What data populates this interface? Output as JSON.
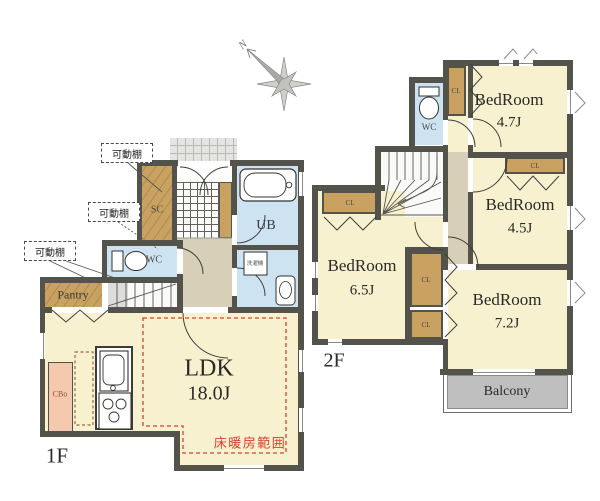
{
  "floor1": {
    "label": "1F",
    "rooms": {
      "ldk": {
        "name": "LDK",
        "area": "18.0J"
      },
      "pantry": {
        "name": "Pantry"
      },
      "toilet": {
        "name": "WC"
      },
      "shoe_closet": {
        "name": "SC"
      },
      "bath": {
        "name": "UB"
      },
      "cupboard": {
        "name": "CBo"
      }
    },
    "notes": {
      "movable_shelf": "可動棚",
      "floor_heating_area": "床暖房範囲",
      "washer": "洗濯機"
    }
  },
  "floor2": {
    "label": "2F",
    "rooms": {
      "bedroom_47": {
        "name": "BedRoom",
        "area": "4.7J"
      },
      "bedroom_45": {
        "name": "BedRoom",
        "area": "4.5J"
      },
      "bedroom_65": {
        "name": "BedRoom",
        "area": "6.5J"
      },
      "bedroom_72": {
        "name": "BedRoom",
        "area": "7.2J"
      },
      "toilet": {
        "name": "WC"
      },
      "balcony": {
        "name": "Balcony"
      }
    },
    "closet_label": "CL"
  },
  "compass": {
    "north_label": "N"
  },
  "colors": {
    "wall": "#53534b",
    "room_cream": "#f8f1d0",
    "closet_tan": "#c9a261",
    "water_blue": "#cde3f2",
    "hall_beige": "#d7cfb8",
    "balcony_gray": "#bfbfbf",
    "cupboard_pink": "#f5c9ae",
    "heating_red": "#d9402e"
  }
}
